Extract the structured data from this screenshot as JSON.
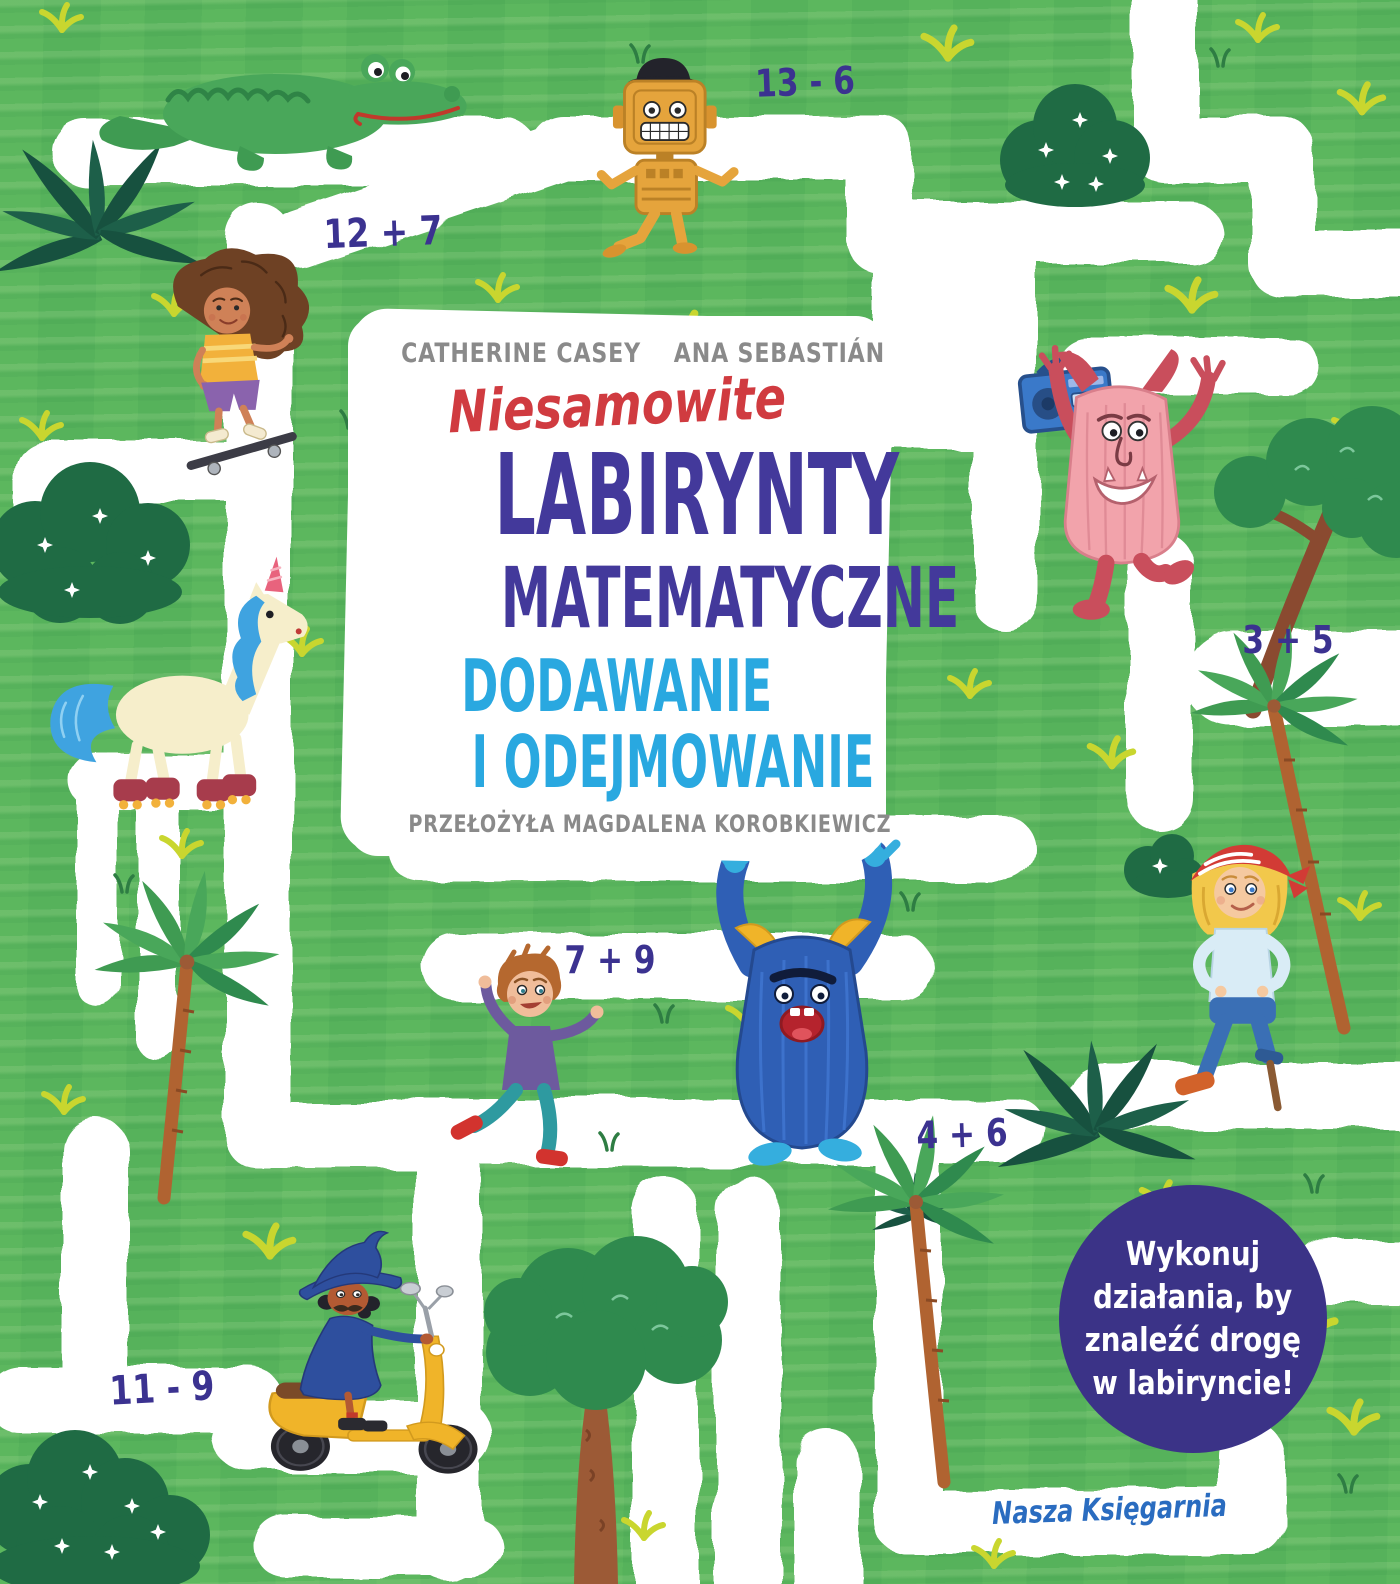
{
  "cover": {
    "author_left": "CATHERINE CASEY",
    "author_right": "ANA SEBASTIÁN",
    "series_script": "Niesamowite",
    "title_line1": "LABIRYNTY",
    "title_line2": "MATEMATYCZNE",
    "subtitle_line1": "DODAWANIE",
    "subtitle_line2": "I ODEJMOWANIE",
    "translator_credit": "PRZEŁOŻYŁA MAGDALENA KOROBKIEWICZ",
    "publisher": "Nasza Księgarnia"
  },
  "badge": {
    "text": "Wykonuj działania, by znaleźć drogę w labiryncie!",
    "lines": [
      "Wykonuj",
      "działania, by",
      "znaleźć drogę",
      "w labiryncie!"
    ]
  },
  "equations": [
    {
      "id": "eq-13-6",
      "label": "13 - 6"
    },
    {
      "id": "eq-12-7",
      "label": "12 + 7"
    },
    {
      "id": "eq-3-5",
      "label": "3 + 5"
    },
    {
      "id": "eq-7-9",
      "label": "7 + 9"
    },
    {
      "id": "eq-4-6",
      "label": "4 + 6"
    },
    {
      "id": "eq-11-9",
      "label": "11 - 9"
    }
  ],
  "scene": {
    "characters": [
      "crocodile",
      "robot with bowler hat",
      "girl on skateboard",
      "unicorn on roller skates",
      "pink monster with boombox",
      "blue monster",
      "running boy",
      "pirate girl with peg leg",
      "wizard on yellow scooter"
    ],
    "scenery": [
      "white maze paths",
      "palm trees",
      "leafy trees",
      "flowering bushes",
      "grass tufts"
    ]
  },
  "colors": {
    "background_green": "#56b25b",
    "path_white": "#ffffff",
    "title_purple": "#43399b",
    "series_red": "#d03b40",
    "subtitle_blue": "#29a8e0",
    "authors_gray": "#8a8a8a",
    "equation_indigo": "#3b3290",
    "badge_purple": "#3b3387",
    "publisher_blue": "#2a6cc0"
  }
}
